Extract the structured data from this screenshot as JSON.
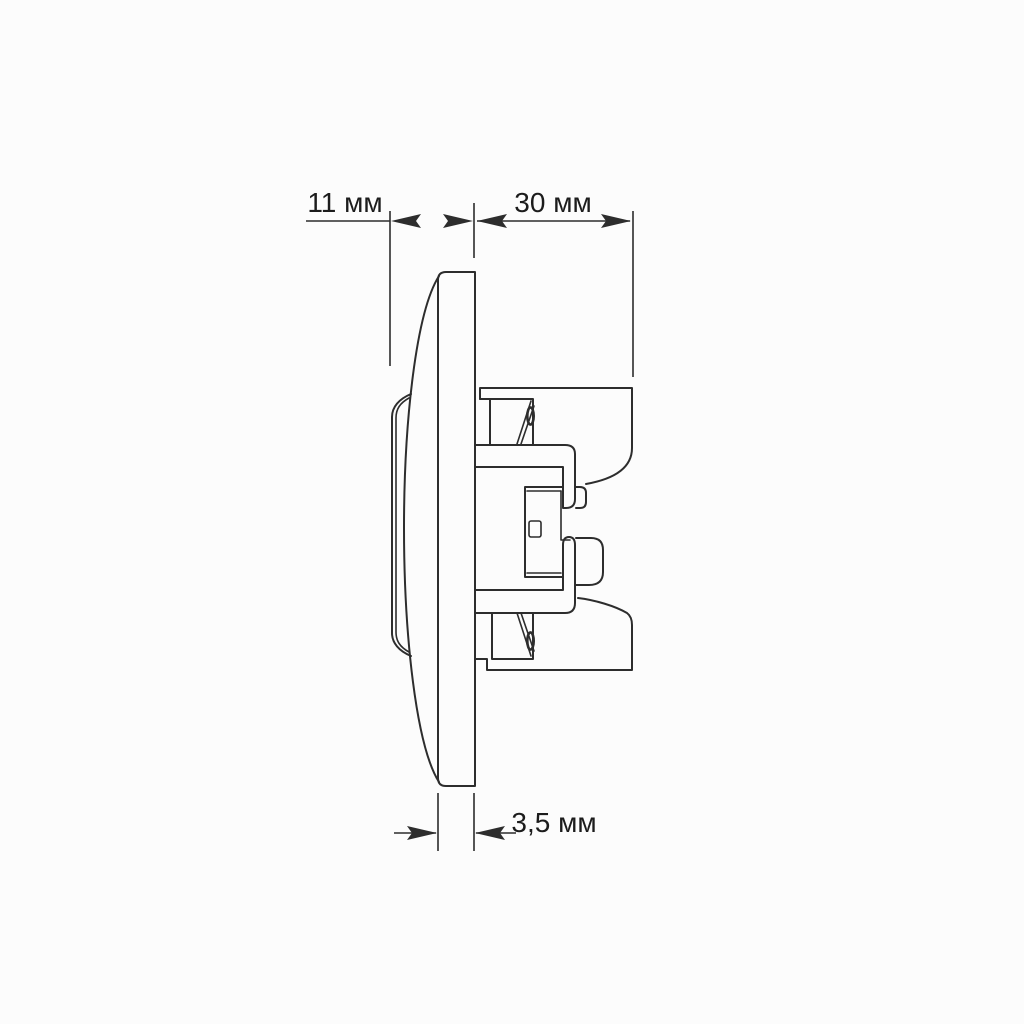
{
  "colors": {
    "line": "#2d2d2d",
    "text": "#1c1c1c",
    "background": "#fcfcfc"
  },
  "drawing": {
    "description": "Side-profile technical dimension drawing of a flush-mounted wall switch (rocker, faceplate and recessed mechanism)",
    "unit": "мм",
    "dimensions": [
      {
        "id": "front-protrusion",
        "label": "11 мм"
      },
      {
        "id": "recessed-mechanism-depth",
        "label": "30 мм"
      },
      {
        "id": "faceplate-thickness",
        "label": "3,5 мм"
      }
    ]
  }
}
